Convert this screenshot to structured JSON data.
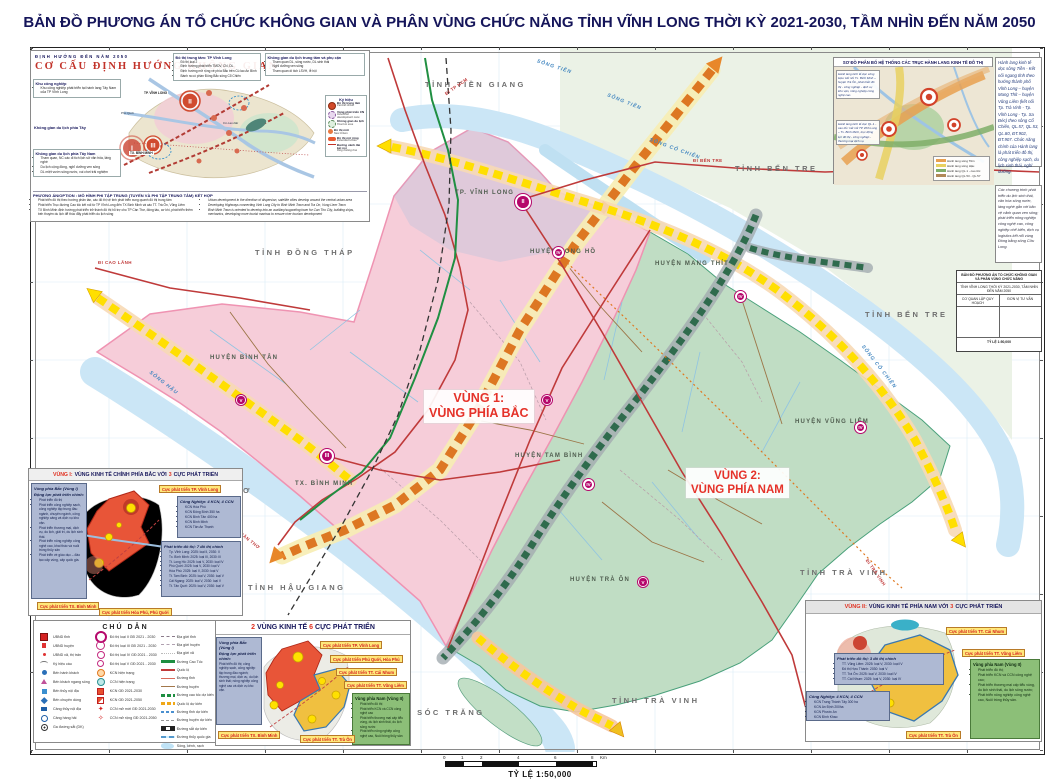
{
  "title": "BẢN ĐỒ PHƯƠNG ÁN TỔ CHỨC KHÔNG GIAN VÀ PHÂN VÙNG CHỨC NĂNG TỈNH VĨNH LONG THỜI KỲ 2021-2030, TẦM NHÌN ĐẾN NĂM 2050",
  "map": {
    "region1": {
      "line1": "VÙNG 1:",
      "line2": "VÙNG PHÍA BẮC"
    },
    "region2": {
      "line1": "VÙNG 2:",
      "line2": "VÙNG PHÍA NAM"
    },
    "province_labels": [
      "TỈNH TIỀN GIANG",
      "TỈNH BẾN TRE",
      "TỈNH BẾN TRE",
      "TỈNH ĐỒNG THÁP",
      "TỈNH HẬU GIANG",
      "TỈNH TRÀ VINH",
      "TỈNH SÓC TRĂNG",
      "TỈNH TRÀ VINH",
      "THƠ"
    ],
    "district_labels": [
      "TP. VĨNH LONG",
      "HUYỆN LONG HỒ",
      "HUYỆN MANG THÍT",
      "HUYỆN BÌNH TÂN",
      "TX. BÌNH MINH",
      "HUYỆN TAM BÌNH",
      "HUYỆN VŨNG LIÊM",
      "HUYỆN TRÀ ÔN"
    ],
    "river_labels": [
      "SÔNG TIỀN",
      "SÔNG TIỀN",
      "SÔNG CỔ CHIÊN",
      "SÔNG CỔ CHIÊN",
      "SÔNG HẬU"
    ],
    "road_labels": [
      "ĐI TP HCM",
      "ĐI CAO LÃNH",
      "ĐI BẾN TRE",
      "ĐI CẦN THƠ",
      "ĐI TRÀ VINH"
    ],
    "markers": [
      "II",
      "III",
      "IV",
      "IV",
      "IV",
      "IV",
      "V",
      "V",
      "V"
    ]
  },
  "orientation_inset": {
    "header": "ĐỊNH HƯỚNG ĐẾN NĂM 2050",
    "title": "CƠ CẤU ĐỊNH HƯỚNG KHÔNG GIAN",
    "sections": [
      {
        "heading": "Khu công nghiệp",
        "bullets": [
          "Khu công nghiệp phát triển tại hành lang Tây Nam của TP Vĩnh Long"
        ]
      },
      {
        "heading": "Không gian du lịch phía Tây",
        "bullets": []
      },
      {
        "heading": "Không gian du lịch phía Tây Nam",
        "bullets": [
          "Tham quan, NC các di tích lịch sử văn hóa, làng nghề",
          "Du lịch cộng đồng, nghỉ dưỡng ven sông",
          "DL miệt vườn sông nước, vui chơi trải nghiệm"
        ]
      }
    ],
    "center_box": {
      "heading": "Đô thị trung tâm: TP Vĩnh Long",
      "bullets": [
        "Đô thị loại 2",
        "Định hướng phát triển TMDV, CN, DL",
        "Định hướng mở rộng về phía Bắc trên Cù lao An Bình",
        "Bành ra có phần Đông Bắc sông Cổ Chiên"
      ]
    },
    "right_box": {
      "heading": "Không gian du lịch trung tâm và phụ cận",
      "bullets": [
        "Tham quan DL, sông nước, DL sinh thái",
        "Nghỉ dưỡng ven sông",
        "Tham quan di tích LSVH, lễ hội"
      ]
    },
    "legend_heading": "Ký hiệu",
    "legend_items": [
      {
        "label": "Đô thị trung tâm",
        "sub": "Central Urban",
        "sym": "ksym-center"
      },
      {
        "label": "Vùng phát triển CN",
        "sub": "Industrial development zone",
        "sym": "ksym-cn"
      },
      {
        "label": "Không gian du lịch",
        "sub": "Tourism area",
        "sym": "ksym-dl"
      },
      {
        "label": "Đô thị mới",
        "sub": "New Urban",
        "sym": "ksym-new"
      },
      {
        "label": "Đô thị mở rộng",
        "sub": "Extended Urban",
        "sym": "ksym-ext"
      }
    ],
    "legend_note": "Đường vành đai kết nối",
    "legend_note_sub": "Ring linking line",
    "minimap_labels": [
      "TP. VĨNH LONG",
      "TX. BÌNH MINH",
      "TP. CẦN THƠ",
      "Cù Lao Dài",
      "Phú Quới"
    ],
    "minimap_markers": [
      "I",
      "II",
      "III"
    ],
    "option_heading": "PHƯƠNG ÁN/OPTION : MÔ HÌNH PHI TẬP TRUNG (TUYẾN VÀ PHI TẬP TRUNG TÂM) KẾT HỢP",
    "option_vn": [
      "Phát triển đô thị theo hướng phân tán, các đô thị vệ tinh phát triển xung quanh đô thị trung tâm",
      "Phát triển Trục đường Cao tốc kết nối từ TP Vĩnh Long đến TX Bình Minh và các TT. Trà Ôn, Vũng Liêm",
      "TX Bình Minh định hướng phát triển trở thành đô thị hỗ trợ cho TP Cần Thơ, đóng tàu, cơ khí, phát triển thêm bến thuyền du lịch để thúc đẩy phát triển du lịch sông"
    ],
    "option_en": [
      "Urban development in the direction of dispersion, satellite cities develop around the central urban area",
      "Developing Highways connecting Vinh Long City to Binh Minh Town and Tra On, Vung Liem Town",
      "Binh Minh Town is oriented to develop into an auxiliary/supporting town for Can Tho City, building ships, mechanics, developing more tourist marinas to ensure river tourism development"
    ]
  },
  "corridor_inset": {
    "title": "SƠ ĐỒ PHÂN BỐ HỆ THỐNG CÁC TRỤC HÀNH LANG KINH TẾ ĐÔ THỊ",
    "left_note1": "Hành lang kinh tế dọc sông Hậu: kết nối Tx. Bình Minh – huyện Trà Ôn, phát triển đô thị - công nghiệp - dịch vụ kho vận, nông nghiệp công nghệ cao.",
    "left_note2": "Hành lang kinh tế dọc QL.1 - cao tốc: kết nối TP Vĩnh Long – Tx. Bình Minh, trục động lực đô thị - công nghiệp - thương mại dịch vụ.",
    "legend": [
      {
        "label": "Hành lang sông Tiền",
        "sym": "cl-orange"
      },
      {
        "label": "Hành lang sông Hậu",
        "sym": "cl-yellow"
      },
      {
        "label": "Hành lang QL.1 - cao tốc",
        "sym": "cl-green"
      },
      {
        "label": "Hành lang QL.53 - QL.57",
        "sym": "cl-brown"
      }
    ]
  },
  "right_note1": "Hành lang kinh tế dọc sông Tiền - Kết nối ngang tỉnh theo hướng thành phố Vĩnh Long – huyện Mang Thít – huyện Vũng Liêm (kết nối Tp. Trà Vinh - Tp. Vĩnh Long - Tp. Sa Đéc) theo sông Cổ Chiên, QL.57, QL.53, QL.80, ĐT.902, ĐT.907. Chức năng chính của Hành lang là phát triển đô thị, công nghiệp sạch, du lịch sinh thái, nghỉ dưỡng.",
  "right_note2": "Các chương trình phát triển du lịch sinh thái, văn hóa sông nước, làng nghề gắn với bảo vệ cảnh quan ven sông; phát triển nông nghiệp công nghệ cao, công nghiệp chế biến, dịch vụ logistics kết nối vùng Đồng bằng sông Cửu Long.",
  "title_block": {
    "line1": "BẢN ĐỒ PHƯƠNG ÁN TỔ CHỨC KHÔNG GIAN VÀ PHÂN VÙNG CHỨC NĂNG",
    "line2": "TỈNH VĨNH LONG THỜI KỲ 2021-2030, TẦM NHÌN ĐẾN NĂM 2050",
    "cell_left": "CƠ QUAN LẬP QUY HOẠCH",
    "cell_right": "ĐƠN VỊ TƯ VẤN",
    "scale": "TỶ LỆ 1:50,000"
  },
  "legend_box": {
    "title": "CHÚ DẪN",
    "col1": [
      {
        "label": "UBND tỉnh",
        "sym": "s-ub1"
      },
      {
        "label": "UBND huyện",
        "sym": "s-ub2"
      },
      {
        "label": "UBND xã, thị trấn",
        "sym": "s-ub3"
      },
      {
        "label": "Ký hiệu cầu",
        "sym": "s-bridge"
      },
      {
        "label": "Bến hành khách",
        "sym": "s-benhk"
      },
      {
        "label": "Bến khách ngang sông",
        "sym": "s-benkns"
      },
      {
        "label": "Bến thủy nội địa",
        "sym": "s-bentnd"
      },
      {
        "label": "Bến chuyên dùng",
        "sym": "s-bencd"
      },
      {
        "label": "Cảng thủy nội địa",
        "sym": "s-cangtnd"
      },
      {
        "label": "Cảng hàng hải",
        "sym": "s-canghh"
      },
      {
        "label": "Ga đường sắt (DK)",
        "sym": "s-ga"
      }
    ],
    "col2": [
      {
        "label": "Đô thị loại II GĐ 2021 - 2030",
        "sym": "s-dt2"
      },
      {
        "label": "Đô thị loại III GĐ 2021 - 2030",
        "sym": "s-dt3"
      },
      {
        "label": "Đô thị loại IV GĐ 2021 - 2030",
        "sym": "s-dt4"
      },
      {
        "label": "Đô thị loại V GĐ 2021 - 2030",
        "sym": "s-dt5"
      },
      {
        "label": "KCN hiện trạng",
        "sym": "s-kcn-ht"
      },
      {
        "label": "CCN hiện trạng",
        "sym": "s-ccn-ht"
      },
      {
        "label": "KCN GĐ 2021-2030",
        "sym": "s-kcn30"
      },
      {
        "label": "KCN GĐ 2021-2050",
        "sym": "s-kcn50"
      },
      {
        "label": "CCN mở mới GĐ 2021-2030",
        "sym": "s-ccn30"
      },
      {
        "label": "CCN mở rộng GĐ 2021-2050",
        "sym": "s-ccn50"
      }
    ],
    "col3": [
      {
        "label": "Địa giới tỉnh",
        "sym": "l-tinh"
      },
      {
        "label": "Địa giới huyện",
        "sym": "l-huyen"
      },
      {
        "label": "Địa giới xã",
        "sym": "l-xa"
      },
      {
        "label": "Đường Cao Tốc",
        "sym": "l-caotoc"
      },
      {
        "label": "Quốc lộ",
        "sym": "l-ql"
      },
      {
        "label": "Đường tỉnh",
        "sym": "l-dt"
      },
      {
        "label": "Đường huyện",
        "sym": "l-dh"
      },
      {
        "label": "Đường cao tốc dự kiến",
        "sym": "l-ct-dk"
      },
      {
        "label": "Quốc lộ dự kiến",
        "sym": "l-ql-dk"
      },
      {
        "label": "Đường tỉnh dự kiến",
        "sym": "l-dt-dk"
      },
      {
        "label": "Đường huyện dự kiến",
        "sym": "l-dh-dk"
      },
      {
        "label": "Đường sắt dự kiến",
        "sym": "l-rail"
      },
      {
        "label": "Đường thủy quốc gia",
        "sym": "l-thuy"
      },
      {
        "label": "Sông, kênh, rạch",
        "sym": "l-song"
      }
    ]
  },
  "region1_inset": {
    "title_pre": "VÙNG I:",
    "title_mid": "VÙNG KINH TẾ CHÍNH PHÍA BẮC VỚI",
    "title_num": "3",
    "title_post": "CỰC PHÁT TRIỂN",
    "left_heading": "Vùng phía Bắc (Vùng I)",
    "left_sub": "Động lực phát triển chính:",
    "left_bullets": [
      "Phát triển đô thị",
      "Phát triển công nghiệp sạch, công nghiệp tập trung đầu ngành, chuyên ngành, công nghiệp cảng và dịch vụ kho vận.",
      "Phát triển thương mại, dịch vụ, du lịch, giải trí, du lịch sinh thái.",
      "Phát triển nông nghiệp công nghệ cao, khai thác và nuôi trồng thủy sản",
      "Phát triển về giáo dục – đào tạo cấp vùng, cấp quốc gia."
    ],
    "industry_heading": "Công Nghiệp: 4 KCN, 4 CCN",
    "industry_bullets": [
      "KCN Hòa Phú",
      "KCN Đông Bình 350 ha",
      "KCN Bình Tân 400 ha",
      "KCN Bình Minh",
      "KCN Tân An Thạnh"
    ],
    "urban_heading": "Phát triển đô thị: 7 đô thị chính",
    "urban_bullets": [
      "Tp. Vĩnh Long: 2025: loại II, 2030: II",
      "Tx. Bình Minh: 2025: loại III, 2030: III",
      "Tt. Long Hồ: 2025: loại V, 2030: loại IV",
      "Phú Quới: 2025: loại V, 2030: loại V",
      "Hòa Phú: 2025: loại V, 2030: loại V",
      "Tt. Tam Bình: 2025: loại V, 2030: loại V",
      "Cái Ngang: 2025: loại V, 2030: loại V",
      "Tt. Tân Quới: 2025: loại V, 2030: loại V"
    ],
    "chip_vl": "Cực phát triển TP. Vĩnh Long",
    "chip_bm": "Cực phát triển TX. Bình Minh",
    "chip_hp": "Cực phát triển Hòa Phú, Phú Quới"
  },
  "two_region_inset": {
    "title_n1": "2",
    "title_t1": "VÙNG KINH TẾ",
    "title_n2": "6",
    "title_t2": "CỰC PHÁT TRIỂN",
    "left_heading": "Vùng phía Bắc (Vùng I)",
    "left_sub": "Động lực phát triển chính:",
    "left_text": "Phát triển đô thị; công nghiệp sạch, công nghiệp tập trung đầu ngành; thương mại, dịch vụ, du lịch sinh thái; nông nghiệp công nghệ cao và dịch vụ kho vận.",
    "chips": [
      "Cực phát triển TP. Vĩnh Long",
      "Cực phát triển Phú Quới, Hòa Phú",
      "Cực phát triển TT. Cái Nhum",
      "Cực phát triển TT. Vũng Liêm",
      "Cực phát triển TX. Bình Minh",
      "Cực phát triển TT. Trà Ôn"
    ],
    "green_heading": "Vùng phía Nam (Vùng II)",
    "green_bullets": [
      "Phát triển đô thị",
      "Phát triển KCN và CCN công nghệ cao",
      "Phát triển thương mại cấp tiểu vùng, du lịch sinh thái, du lịch sông nước",
      "Phát triển nông nghiệp công nghệ cao, Nuôi trồng thủy sản"
    ]
  },
  "region2_inset": {
    "title_pre": "VÙNG II:",
    "title_mid": "VÙNG KINH TẾ PHÍA NAM VỚI",
    "title_num": "3",
    "title_post": "CỰC PHÁT TRIỂN",
    "urban_heading": "Phát triển đô thị: 3 đô thị chính",
    "urban_bullets": [
      "TT. Vũng Liêm: 2025: loại V; 2030: loại IV",
      "Đô thị Hựu Thành: 2030: loại V",
      "TT. Trà Ôn: 2025: loại V, 2030: loại IV",
      "TT. Cái Nhum: 2025: loại V, 2030: loại IV"
    ],
    "industry_heading": "Công Nghiệp: 4 KCN, 4 CCN",
    "industry_bullets": [
      "KCN Trung Thành Tây 300 ha",
      "KCN An Định 200ha",
      "KCN Phước An",
      "KCN Đình Khao"
    ],
    "green_heading": "Vùng phía Nam (Vùng II)",
    "green_bullets": [
      "Phát triển đô thị;",
      "Phát triển KCN và CCN công nghệ cao;",
      "Phát triển thương mại cấp tiểu vùng, du lịch sinh thái, du lịch sông nước;",
      "Phát triển nông nghiệp công nghệ cao, Nuôi trồng thủy sản."
    ],
    "chip_cn": "Cực phát triển TT. Cái Nhum",
    "chip_vlm": "Cực phát triển TT. Vũng Liêm",
    "chip_to": "Cực phát triển TT. Trà Ôn"
  },
  "scalebar": {
    "t0": "0",
    "t1": "1",
    "t2": "2",
    "t4": "4",
    "t6": "6",
    "t8": "8",
    "unit": "Km",
    "label": "TỶ LỆ 1:50,000"
  }
}
